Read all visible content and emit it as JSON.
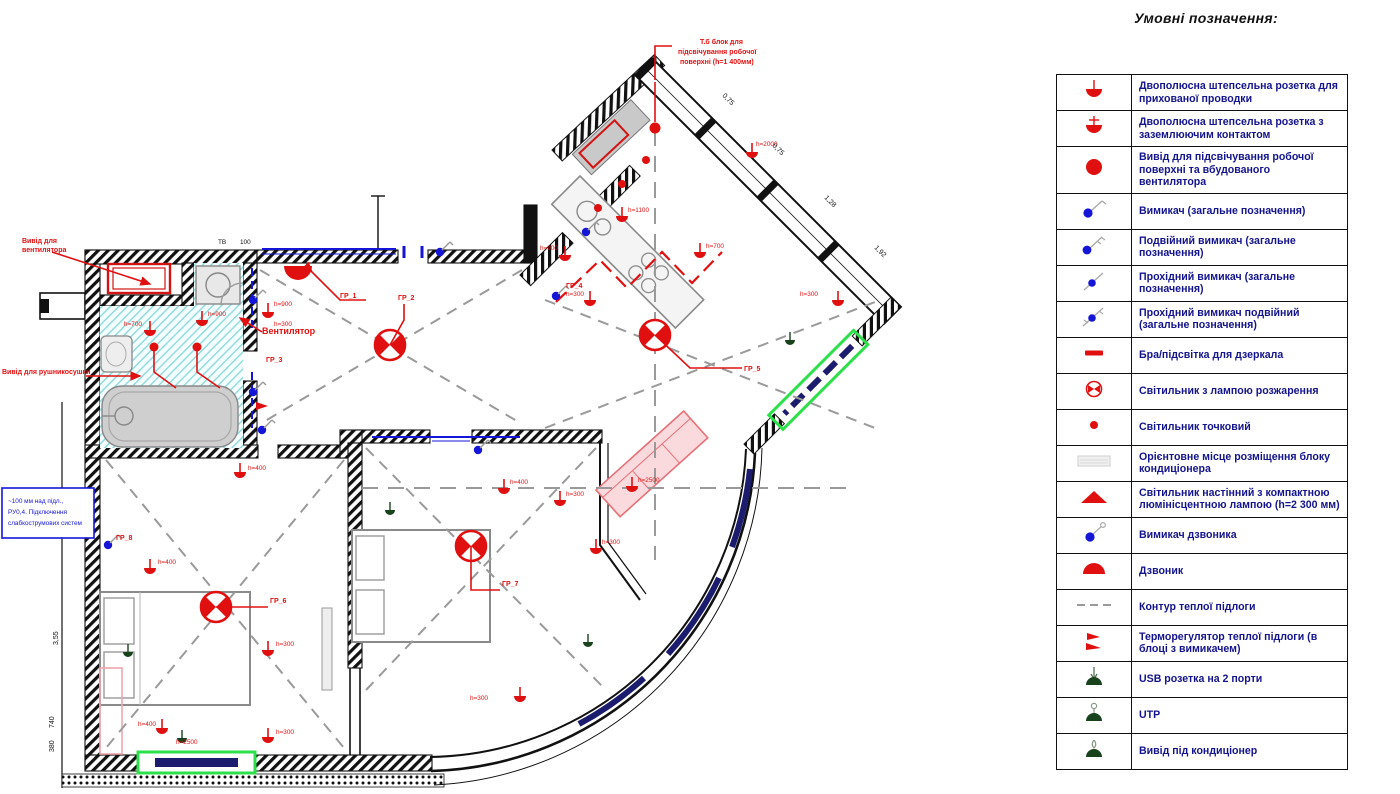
{
  "legend": {
    "title": "Умовні позначення:",
    "rows": [
      {
        "icon": "socket-hidden-icon",
        "label": "Двополюсна штепсельна розетка для прихованої проводки"
      },
      {
        "icon": "socket-grounded-icon",
        "label": "Двополюсна штепсельна розетка з заземлюючим контактом"
      },
      {
        "icon": "worktop-light-outlet-icon",
        "label": "Вивід для підсвічування робочої поверхні та вбудованого вентилятора"
      },
      {
        "icon": "switch-icon",
        "label": "Вимикач (загальне позначення)"
      },
      {
        "icon": "switch-double-icon",
        "label": "Подвійний вимикач (загальне позначення)"
      },
      {
        "icon": "switch-pass-icon",
        "label": "Прохідний вимикач (загальне позначення)"
      },
      {
        "icon": "switch-pass-double-icon",
        "label": "Прохідний вимикач подвійний (загальне позначення)"
      },
      {
        "icon": "mirror-light-icon",
        "label": "Бра/підсвітка для дзеркала"
      },
      {
        "icon": "incandescent-lamp-icon",
        "label": "Світильник з лампою розжарення"
      },
      {
        "icon": "spot-light-icon",
        "label": "Світильник точковий"
      },
      {
        "icon": "ac-unit-place-icon",
        "label": "Орієнтовне місце розміщення блоку кондиціонера"
      },
      {
        "icon": "wall-cfl-lamp-icon",
        "label": "Світильник настінний з компактною люмінісцентною лампою (h=2 300 мм)"
      },
      {
        "icon": "doorbell-switch-icon",
        "label": "Вимикач дзвоника"
      },
      {
        "icon": "doorbell-icon",
        "label": "Дзвоник"
      },
      {
        "icon": "warm-floor-contour-icon",
        "label": "Контур теплої підлоги"
      },
      {
        "icon": "floor-thermostat-icon",
        "label": "Терморегулятор теплої підлоги (в блоці з вимикачем)"
      },
      {
        "icon": "usb-socket-icon",
        "label": "USB розетка на 2 порти"
      },
      {
        "icon": "utp-icon",
        "label": "UTP"
      },
      {
        "icon": "ac-outlet-icon",
        "label": "Вивід під кондиціонер"
      }
    ]
  },
  "plan": {
    "annotations": {
      "worktop_l1": "Т.б блок для",
      "worktop_l2": "підсвічування робочої",
      "worktop_l3": "поверхні (h=1 400мм)",
      "vent_out_l1": "Вивід для",
      "vent_out_l2": "вентилятора",
      "towel": "Вивід для рушникосушки",
      "fan": "Вентилятор",
      "bluebox_l1": "~100 мм над підл.,",
      "bluebox_l2": "РУ0,4. Підключення",
      "bluebox_l3": "слабкострумових систем"
    },
    "groups": {
      "g1": "ГР_1",
      "g2": "ГР_2",
      "g3": "ГР_3",
      "g4": "ГР_4",
      "g5": "ГР_5",
      "g6": "ГР_6",
      "g7": "ГР_7",
      "g8": "ГР_8"
    },
    "heights": {
      "h300": "h=300",
      "h400": "h=400",
      "h700": "h=700",
      "h900": "h=900",
      "h1100": "h=1100",
      "h2000": "h=2000",
      "h2500": "h=2500"
    },
    "dims": {
      "d1": "3,55",
      "d2": "740",
      "d3": "380",
      "w1": "0,75",
      "w2": "0,75",
      "w3": "1,28",
      "w4": "1,92",
      "tv": "ТВ",
      "tv100": "100"
    }
  }
}
